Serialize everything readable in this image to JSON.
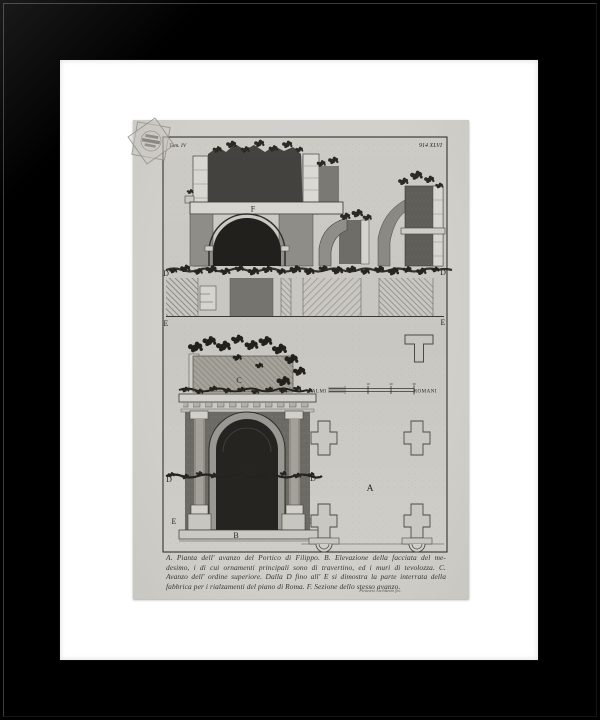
{
  "frame": {
    "color": "#000000",
    "mat_color": "#ffffff"
  },
  "print": {
    "paper_color": "#d3d1cc",
    "plate_bg_color": "#cbc9c3",
    "ink_color": "#2b2a26",
    "header": {
      "volume": "Tom. IV",
      "plate_number": "914 XLVI"
    },
    "labels": {
      "a": "A",
      "b": "B",
      "c": "C",
      "d": "D",
      "e": "E",
      "f": "F"
    },
    "scale_bar": {
      "left_label": "PALMI",
      "right_label": "ROMANI",
      "tick_labels": [
        "10",
        "20",
        "30"
      ]
    },
    "caption_lines": [
      "A. Pianta dell' avanzo del Portico di Filippo. B. Elevazione della facciata del me-",
      "desimo, i di cui ornamenti principali sono di travertino, ed i muri di tevolozza. C.",
      "Avanzo dell' ordine superiore. Dalla D fino all' E si dimostra la parte interrata della",
      "fabbrica per i rialzamenti del piano di Roma. F. Sezione dello stesso avanzo."
    ],
    "signature": "Piranesi Architetto fec."
  }
}
